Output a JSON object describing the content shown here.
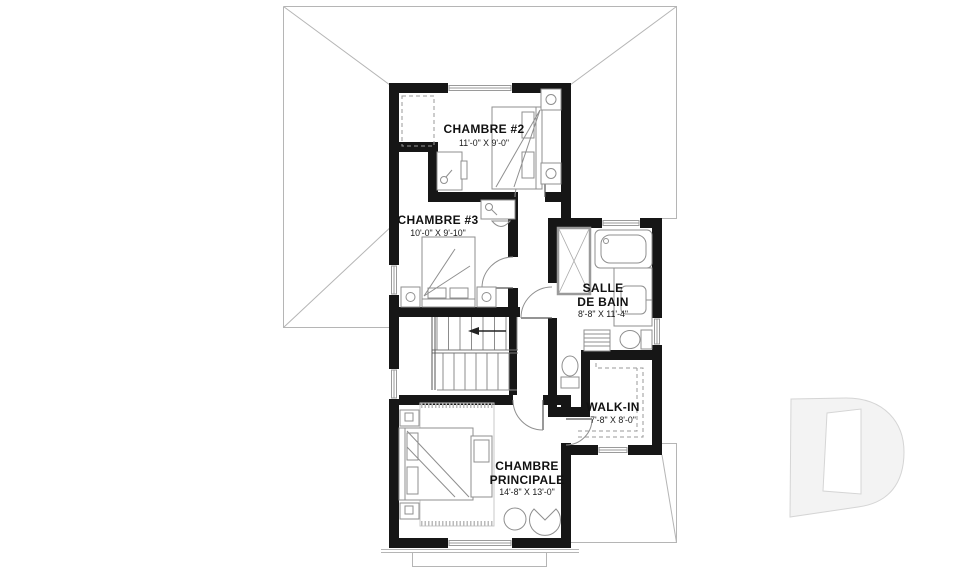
{
  "plan": {
    "title_note": "second floor plan",
    "rooms": [
      {
        "name": "chambre-2",
        "label": "CHAMBRE #2",
        "dimensions": "11'-0\" X 9'-0\""
      },
      {
        "name": "chambre-3",
        "label": "CHAMBRE #3",
        "dimensions": "10'-0\" X 9'-10\""
      },
      {
        "name": "salle-de-bain",
        "label_line1": "SALLE",
        "label_line2": "DE BAIN",
        "dimensions": "8'-8\" X 11'-4\""
      },
      {
        "name": "walk-in",
        "label": "WALK-IN",
        "dimensions": "7'-8\" X 8'-0\""
      },
      {
        "name": "chambre-principale",
        "label_line1": "CHAMBRE",
        "label_line2": "PRINCIPALE",
        "dimensions": "14'-8\" X 13'-0\""
      }
    ],
    "icons": {
      "stair_arrow": "left-arrow",
      "watermark_logo": "drummond-d-logo"
    },
    "colors": {
      "wall": "#161616",
      "roof_line": "#b5b5b5",
      "fixture_line": "#8f8f8f",
      "text": "#111111",
      "watermark_fill": "#f3f3f3",
      "watermark_stroke": "#d5d5d5",
      "background": "#ffffff"
    }
  }
}
